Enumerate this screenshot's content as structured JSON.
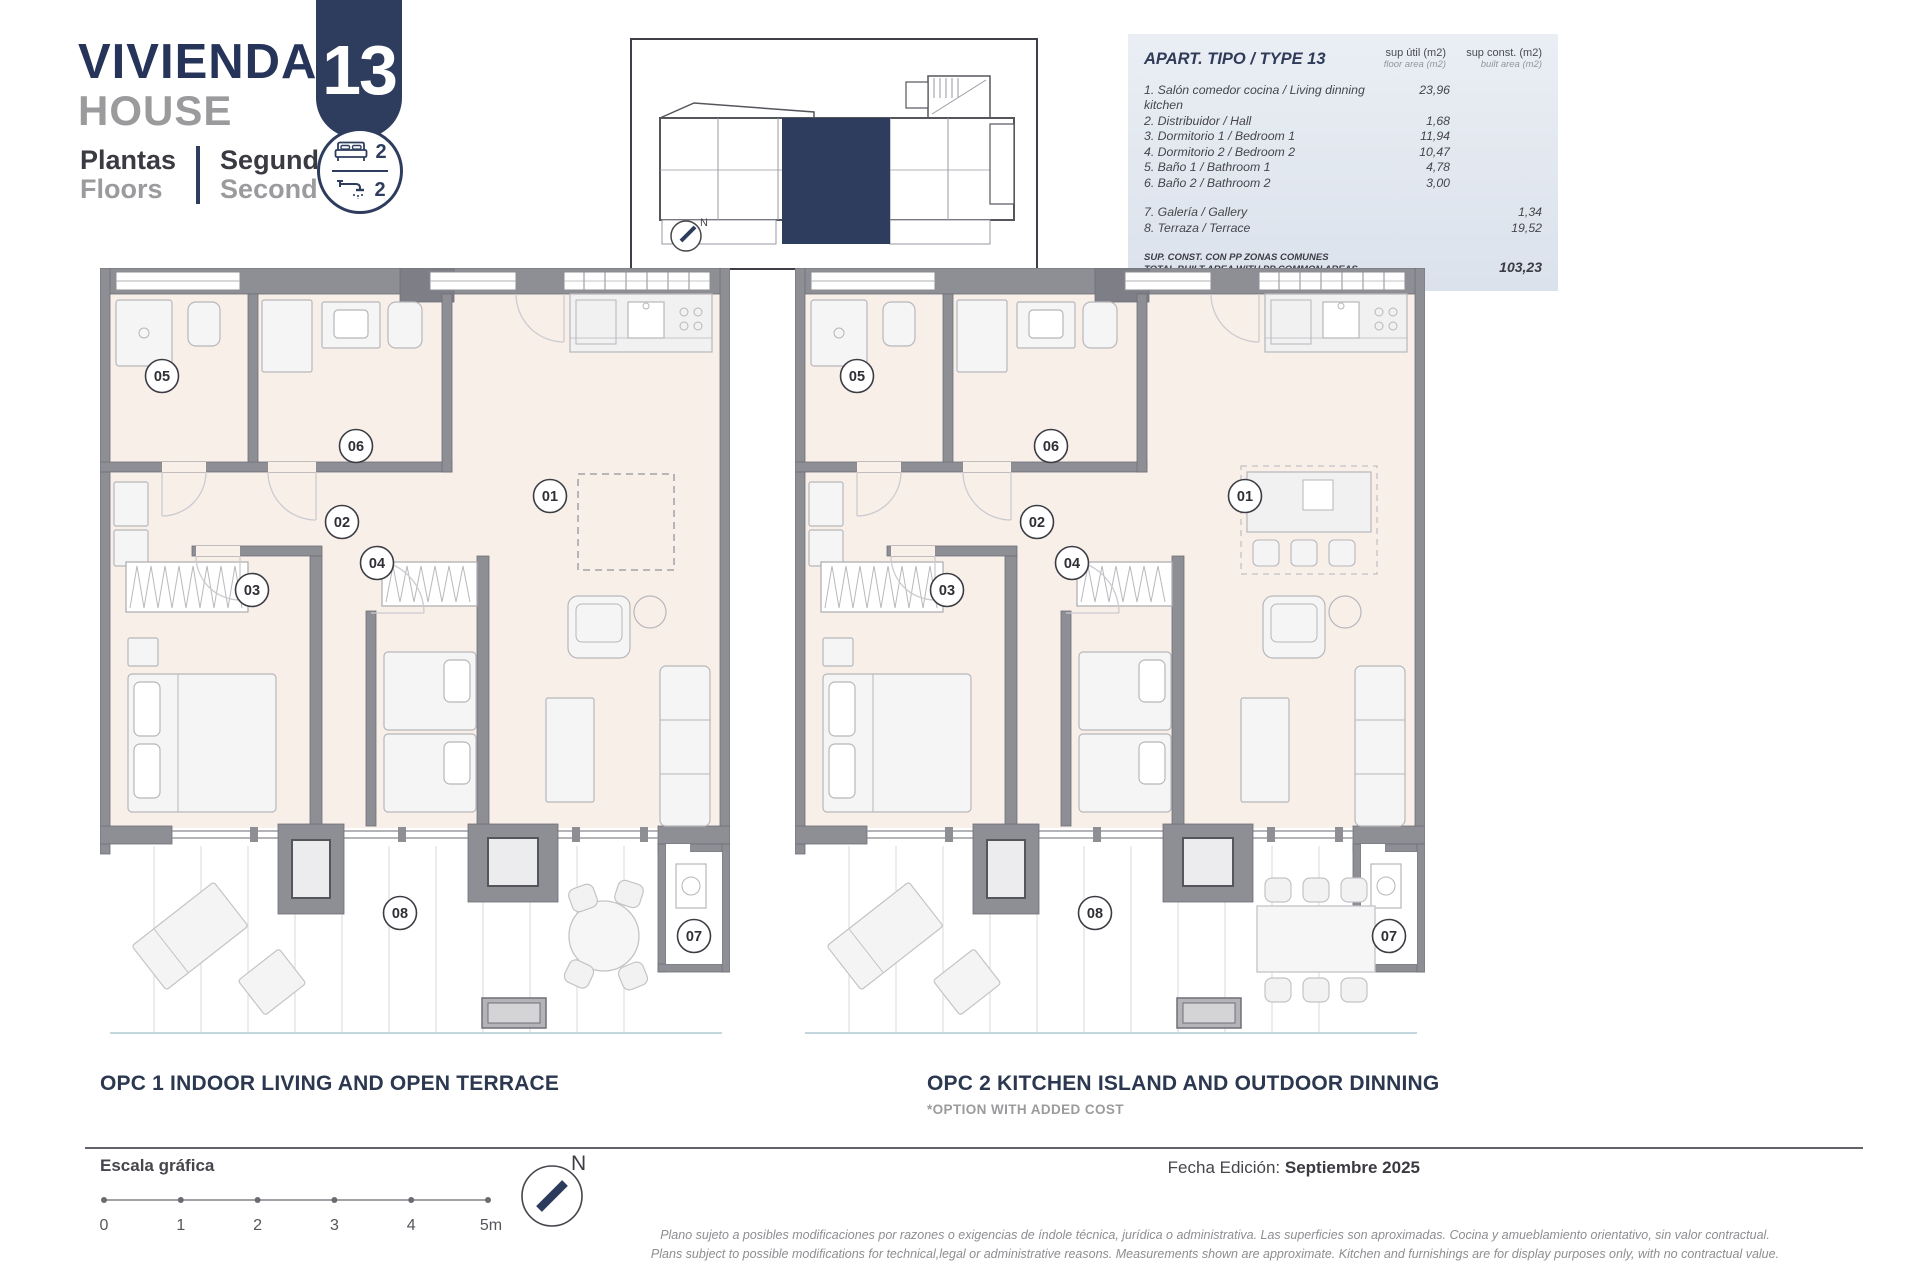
{
  "header": {
    "title_primary": "VIVIENDA",
    "title_secondary": "HOUSE",
    "floors_label_primary": "Plantas",
    "floors_label_secondary": "Floors",
    "floors_value_primary": "Segunda",
    "floors_value_secondary": "Second",
    "unit_number": "13",
    "bedrooms_count": "2",
    "bathrooms_count": "2"
  },
  "key_plan": {
    "north_label": "N"
  },
  "area_table": {
    "title": "APART. TIPO / TYPE 13",
    "columns": [
      {
        "line1": "sup útil (m2)",
        "line2": "floor area (m2)"
      },
      {
        "line1": "sup const. (m2)",
        "line2": "built area (m2)"
      }
    ],
    "rows": [
      {
        "label": "1. Salón comedor cocina / Living dinning kitchen",
        "floor_area": "23,96",
        "built_area": ""
      },
      {
        "label": "2. Distribuidor / Hall",
        "floor_area": "1,68",
        "built_area": ""
      },
      {
        "label": "3. Dormitorio 1 / Bedroom 1",
        "floor_area": "11,94",
        "built_area": ""
      },
      {
        "label": "4. Dormitorio 2 / Bedroom 2",
        "floor_area": "10,47",
        "built_area": ""
      },
      {
        "label": "5. Baño 1 / Bathroom 1",
        "floor_area": "4,78",
        "built_area": ""
      },
      {
        "label": "6. Baño 2 / Bathroom 2",
        "floor_area": "3,00",
        "built_area": ""
      },
      {
        "label": "7. Galería / Gallery",
        "floor_area": "",
        "built_area": "1,34",
        "gap_before": true
      },
      {
        "label": "8. Terraza / Terrace",
        "floor_area": "",
        "built_area": "19,52"
      }
    ],
    "total_label_primary": "SUP. CONST. CON PP ZONAS COMUNES",
    "total_label_secondary": "TOTAL BUILT AREA WITH PP COMMON AREAS",
    "total_value": "103,23"
  },
  "plans": [
    {
      "id": "opc1",
      "variant": "open_terrace",
      "caption": "OPC 1 INDOOR LIVING AND OPEN TERRACE",
      "subcaption": ""
    },
    {
      "id": "opc2",
      "variant": "kitchen_island",
      "caption": "OPC 2 KITCHEN ISLAND AND OUTDOOR DINNING",
      "subcaption": "*OPTION WITH ADDED COST"
    }
  ],
  "room_labels": [
    "01",
    "02",
    "03",
    "04",
    "05",
    "06",
    "07",
    "08"
  ],
  "footer": {
    "scale_label": "Escala gráfica",
    "scale_ticks": [
      "0",
      "1",
      "2",
      "3",
      "4",
      "5m"
    ],
    "north_label": "N",
    "edition_label": "Fecha Edición:",
    "edition_value": "Septiembre 2025",
    "disclaimer_line1": "Plano sujeto a posibles modificaciones por razones o exigencias de índole técnica,  jurídica o administrativa. Las superficies son aproximadas. Cocina y amueblamiento orientativo, sin valor contractual.",
    "disclaimer_line2": "Plans subject to possible modifications for technical,legal or administrative reasons. Measurements shown are approximate. Kitchen and furnishings are for display purposes only, with no contractual value."
  },
  "colors": {
    "navy": "#2e3d5e",
    "title_navy": "#27345a",
    "gray_text": "#9b9b9e",
    "dark_text": "#3e3e46",
    "wall": "#8e8e95",
    "floor": "#f8efe9",
    "table_bg": "#e2e8ef",
    "deck_line": "#d9d9dc"
  }
}
